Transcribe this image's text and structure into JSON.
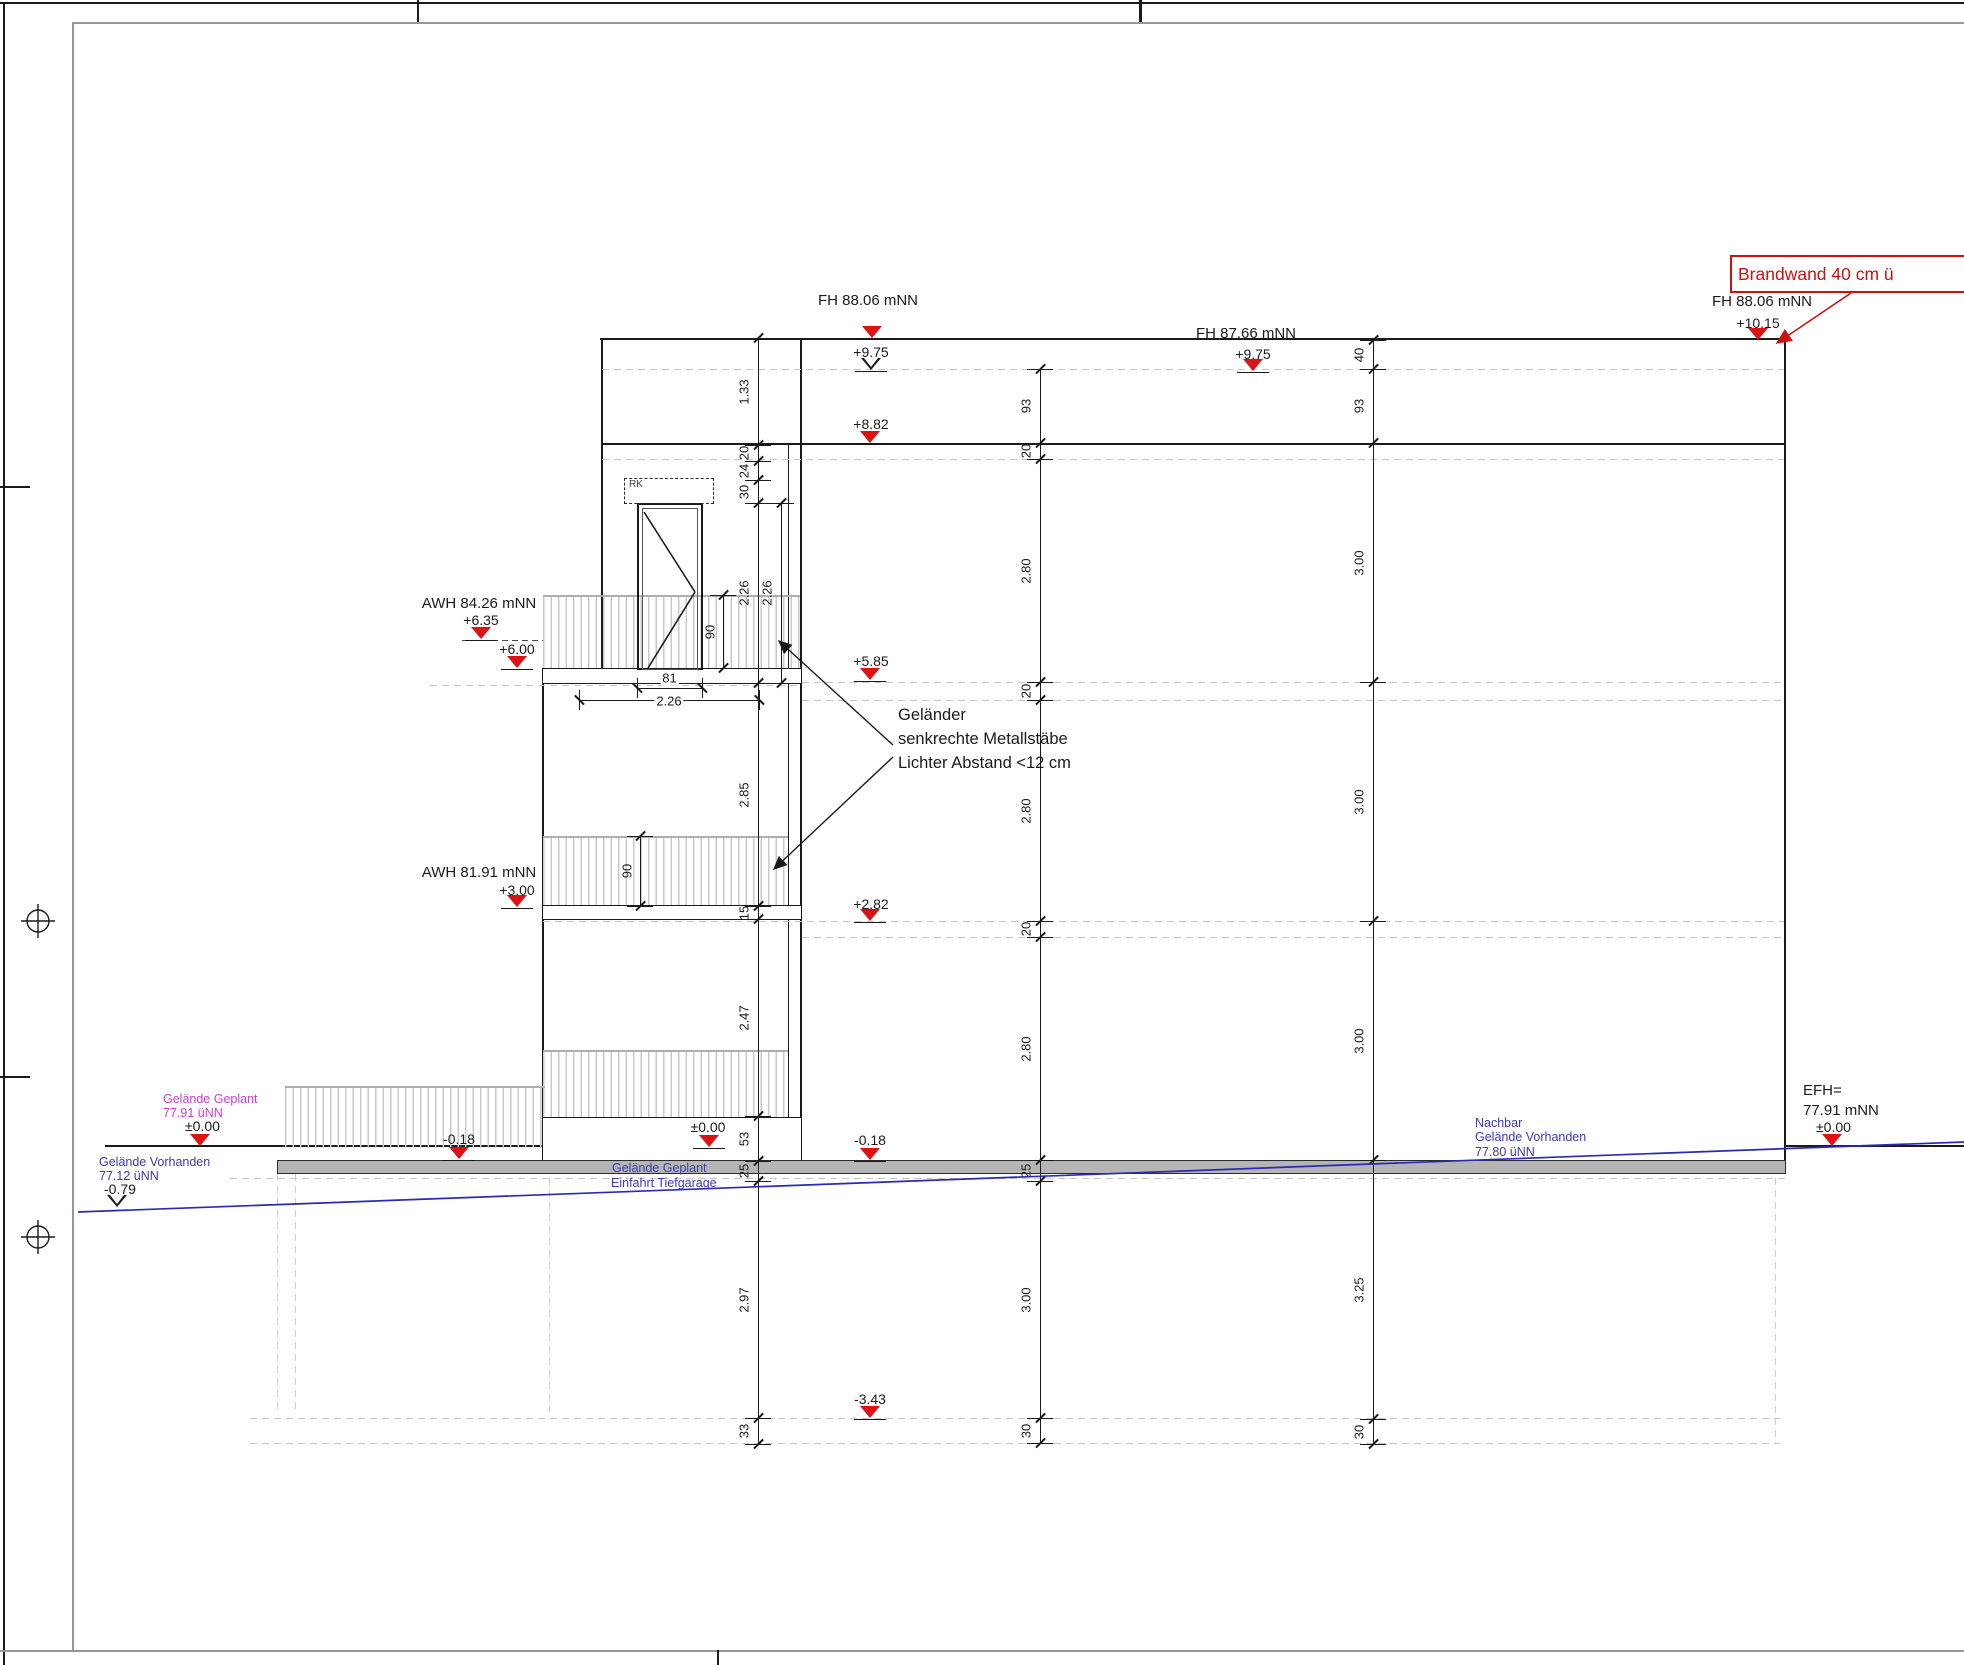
{
  "brandwand_label": "Brandwand 40 cm ü",
  "rk_label": "RK",
  "note_lines": [
    "Geländer",
    "senkrechte Metallstäbe",
    "Lichter Abstand <12 cm"
  ],
  "colors": {
    "accent_red": "#dd1212",
    "blue": "#3a3ab8",
    "magenta": "#cc3ecc",
    "terrain_blue": "#2a2ab5",
    "line": "#1a1a1a",
    "dash_gray": "#c5c5c5",
    "slab_gray": "#b5b5b5"
  },
  "texts": [
    {
      "x": 868,
      "y": 292,
      "size": 15,
      "t": "FH 88.06 mNN",
      "anchor": "center",
      "name": "level-label-fh-8806-center"
    },
    {
      "x": 871,
      "y": 344,
      "size": 14,
      "t": "+9.75",
      "anchor": "center",
      "name": "level-value"
    },
    {
      "x": 1246,
      "y": 325,
      "size": 15,
      "t": "FH 87.66 mNN",
      "anchor": "center",
      "name": "level-label-fh-8766"
    },
    {
      "x": 1253,
      "y": 346,
      "size": 14,
      "t": "+9.75",
      "anchor": "center",
      "name": "level-value"
    },
    {
      "x": 1762,
      "y": 293,
      "size": 15,
      "t": "FH 88.06 mNN",
      "anchor": "center",
      "name": "level-label-fh-8806-right"
    },
    {
      "x": 1758,
      "y": 315,
      "size": 14,
      "t": "+10.15",
      "anchor": "center",
      "name": "level-value"
    },
    {
      "x": 871,
      "y": 416,
      "size": 14,
      "t": "+8.82",
      "anchor": "center",
      "name": "level-value"
    },
    {
      "x": 871,
      "y": 653,
      "size": 14,
      "t": "+5.85",
      "anchor": "center",
      "name": "level-value"
    },
    {
      "x": 871,
      "y": 896,
      "size": 14,
      "t": "+2.82",
      "anchor": "center",
      "name": "level-value"
    },
    {
      "x": 870,
      "y": 1132,
      "size": 14,
      "t": "-0.18",
      "anchor": "center",
      "name": "level-value"
    },
    {
      "x": 870,
      "y": 1391,
      "size": 14,
      "t": "-3.43",
      "anchor": "center",
      "name": "level-value"
    },
    {
      "x": 479,
      "y": 595,
      "size": 15,
      "t": "AWH 84.26 mNN",
      "anchor": "center",
      "name": "level-label-awh-8426"
    },
    {
      "x": 481,
      "y": 612,
      "size": 14,
      "t": "+6.35",
      "anchor": "center",
      "name": "level-value"
    },
    {
      "x": 517,
      "y": 641,
      "size": 14,
      "t": "+6.00",
      "anchor": "center",
      "name": "level-value"
    },
    {
      "x": 479,
      "y": 864,
      "size": 15,
      "t": "AWH 81.91 mNN",
      "anchor": "center",
      "name": "level-label-awh-8191"
    },
    {
      "x": 517,
      "y": 882,
      "size": 14,
      "t": "+3.00",
      "anchor": "center",
      "name": "level-value"
    },
    {
      "x": 163,
      "y": 1092,
      "size": 12.5,
      "t": "Gelände Geplant",
      "color": "#cc3ecc",
      "anchor": "left",
      "name": "terrain-planned-label"
    },
    {
      "x": 163,
      "y": 1106,
      "size": 12.5,
      "t": "77.91 üNN",
      "color": "#cc3ecc",
      "anchor": "left",
      "name": "terrain-planned-elevation"
    },
    {
      "x": 185,
      "y": 1118,
      "size": 14,
      "t": "±0.00",
      "anchor": "left",
      "name": "level-value"
    },
    {
      "x": 99,
      "y": 1155,
      "size": 12.5,
      "t": "Gelände Vorhanden",
      "color": "#3a3ab8",
      "anchor": "left",
      "name": "terrain-existing-label"
    },
    {
      "x": 99,
      "y": 1169,
      "size": 12.5,
      "t": "77.12 üNN",
      "color": "#3a3ab8",
      "anchor": "left",
      "name": "terrain-existing-elevation"
    },
    {
      "x": 104,
      "y": 1181,
      "size": 14,
      "t": "-0.79",
      "anchor": "left",
      "name": "level-value"
    },
    {
      "x": 459,
      "y": 1131,
      "size": 14,
      "t": "-0.18",
      "anchor": "center",
      "name": "level-value"
    },
    {
      "x": 708,
      "y": 1119,
      "size": 14,
      "t": "±0.00",
      "anchor": "center",
      "name": "level-value"
    },
    {
      "x": 612,
      "y": 1161,
      "size": 12.5,
      "t": "Gelände Geplant",
      "color": "#3a3ab8",
      "anchor": "left",
      "name": "driveway-label-line1"
    },
    {
      "x": 611,
      "y": 1176,
      "size": 12.5,
      "t": "Einfahrt Tiefgarage",
      "color": "#3a3ab8",
      "anchor": "left",
      "name": "driveway-label-line2"
    },
    {
      "x": 1475,
      "y": 1116,
      "size": 12.5,
      "t": "Nachbar",
      "color": "#3a3ab8",
      "anchor": "left",
      "name": "neighbor-label-line1"
    },
    {
      "x": 1475,
      "y": 1130,
      "size": 12.5,
      "t": "Gelände Vorhanden",
      "color": "#3a3ab8",
      "anchor": "left",
      "name": "neighbor-label-line2"
    },
    {
      "x": 1475,
      "y": 1145,
      "size": 12.5,
      "t": "77.80 üNN",
      "color": "#3a3ab8",
      "anchor": "left",
      "name": "neighbor-elevation"
    },
    {
      "x": 1803,
      "y": 1082,
      "size": 15,
      "t": "EFH=",
      "anchor": "left",
      "name": "efh-label"
    },
    {
      "x": 1803,
      "y": 1102,
      "size": 15,
      "t": "77.91 mNN",
      "anchor": "left",
      "name": "efh-elevation"
    },
    {
      "x": 1816,
      "y": 1119,
      "size": 14,
      "t": "±0.00",
      "anchor": "left",
      "name": "level-value"
    },
    {
      "x": 898,
      "y": 706,
      "size": 16.5,
      "t": "Geländer",
      "anchor": "left",
      "name": "railing-note-line1"
    },
    {
      "x": 898,
      "y": 730,
      "size": 16.5,
      "t": "senkrechte Metallstäbe",
      "anchor": "left",
      "name": "railing-note-line2"
    },
    {
      "x": 898,
      "y": 754,
      "size": 16.5,
      "t": "Lichter Abstand <12 cm",
      "anchor": "left",
      "name": "railing-note-line3"
    }
  ],
  "triangles": [
    {
      "x": 872,
      "y": 338,
      "type": "filled",
      "underline": false
    },
    {
      "x": 871,
      "y": 370,
      "type": "open",
      "underline": true
    },
    {
      "x": 1253,
      "y": 371,
      "type": "filled",
      "underline": true
    },
    {
      "x": 1758,
      "y": 340,
      "type": "filled",
      "underline": false
    },
    {
      "x": 870,
      "y": 443,
      "type": "filled",
      "underline": false
    },
    {
      "x": 870,
      "y": 680,
      "type": "filled",
      "underline": true
    },
    {
      "x": 870,
      "y": 921,
      "type": "filled",
      "underline": true
    },
    {
      "x": 870,
      "y": 1160,
      "type": "filled",
      "underline": true
    },
    {
      "x": 870,
      "y": 1418,
      "type": "filled",
      "underline": true
    },
    {
      "x": 481,
      "y": 639,
      "type": "filled",
      "underline": true
    },
    {
      "x": 517,
      "y": 668,
      "type": "filled",
      "underline": true
    },
    {
      "x": 517,
      "y": 907,
      "type": "filled",
      "underline": true
    },
    {
      "x": 200,
      "y": 1146,
      "type": "filled",
      "underline": false
    },
    {
      "x": 117,
      "y": 1207,
      "type": "open",
      "underline": false
    },
    {
      "x": 459,
      "y": 1159,
      "type": "filled",
      "underline": true
    },
    {
      "x": 709,
      "y": 1147,
      "type": "filled",
      "underline": true
    },
    {
      "x": 1832,
      "y": 1146,
      "type": "filled",
      "underline": false
    }
  ],
  "dim_chains": [
    {
      "name": "dim-chain-left",
      "x": 758,
      "label_dx": -14,
      "ticks": [
        338,
        445,
        461,
        480,
        503,
        683,
        906,
        919,
        1116,
        1161,
        1181,
        1418,
        1444
      ],
      "labels": [
        "1.33",
        "20",
        "24",
        "30",
        "2.26",
        "2.85",
        "15",
        "2.47",
        "53",
        "25",
        "2.97",
        "33"
      ]
    },
    {
      "name": "dim-chain-left-2",
      "x": 781,
      "label_dx": -14,
      "ticks": [
        503,
        683
      ],
      "labels": [
        "2.26"
      ]
    },
    {
      "name": "dim-chain-middle",
      "x": 1040,
      "label_dx": -14,
      "ticks": [
        369,
        443,
        459,
        682,
        700,
        921,
        937,
        1160,
        1181,
        1418,
        1443
      ],
      "labels": [
        "93",
        "20",
        "2.80",
        "20",
        "2.80",
        "20",
        "2.80",
        "25",
        "3.00",
        "30"
      ]
    },
    {
      "name": "dim-chain-right",
      "x": 1373,
      "label_dx": -14,
      "ticks": [
        340,
        369,
        443,
        682,
        921,
        1160,
        1419,
        1444
      ],
      "labels": [
        "40",
        "93",
        "3.00",
        "3.00",
        "3.00",
        "3.25",
        "30"
      ]
    },
    {
      "name": "railing-height-dim-upper",
      "x": 723,
      "label_dx": -13,
      "ticks": [
        595,
        668
      ],
      "labels": [
        "90"
      ]
    },
    {
      "name": "railing-height-dim-lower",
      "x": 640,
      "label_dx": -13,
      "ticks": [
        836,
        906
      ],
      "labels": [
        "90"
      ]
    }
  ],
  "h_dims": [
    {
      "y": 688,
      "x1": 637,
      "x2": 702,
      "label": "81",
      "label_dy": -10,
      "name": "door-width-dim"
    },
    {
      "y": 700,
      "x1": 579,
      "x2": 759,
      "label": "2.26",
      "label_dy": 1,
      "name": "balcony-width-dim"
    }
  ]
}
